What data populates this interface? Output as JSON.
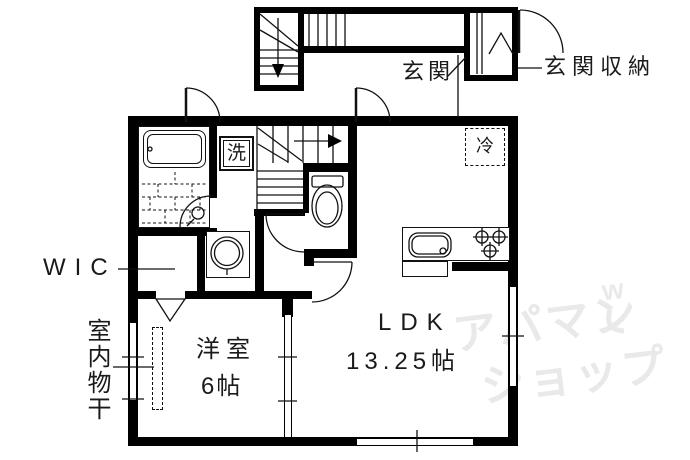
{
  "plan": {
    "rooms": {
      "entrance_label": "玄関",
      "entrance_storage_label": "玄関収納",
      "wic_label": "WIC",
      "indoor_drying_label": "室内物干",
      "western_room_label": "洋室",
      "western_room_size": "6帖",
      "ldk_label": "LDK",
      "ldk_size": "13.25帖",
      "washing_machine_label": "洗",
      "refrigerator_label": "冷"
    },
    "watermark": {
      "line1": "アパマン",
      "line2": "ショップ",
      "mark": "w",
      "color": "#e9e9e9"
    },
    "colors": {
      "background": "#ffffff",
      "wall": "#000000",
      "line": "#1a1a1a"
    }
  }
}
